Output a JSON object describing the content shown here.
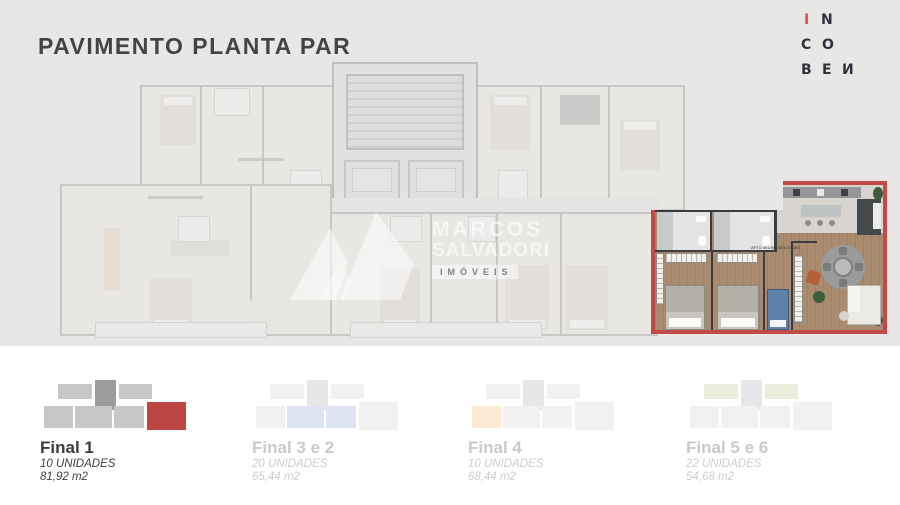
{
  "header": {
    "title": "PAVIMENTO PLANTA PAR"
  },
  "brand": {
    "letters": {
      "l1": "I",
      "l2": "N",
      "l3": "C",
      "l4": "O",
      "l5": "B",
      "l6": "E",
      "l7": "И"
    },
    "accent_color": "#de5147"
  },
  "watermark": {
    "line1": "MARCOS",
    "line2": "SALVADORI",
    "line3": "IMÓVEIS"
  },
  "floorplan": {
    "highlight_border_color": "#c04b48",
    "unit_label": "APTO 401/501/601/701/801"
  },
  "unit_options": [
    {
      "name": "Final 1",
      "units": "10 UNIDADES",
      "area": "81,92 m2",
      "active": true,
      "highlight_color": "#bb4543"
    },
    {
      "name": "Final 3 e 2",
      "units": "20 UNIDADES",
      "area": "65,44 m2",
      "active": false,
      "highlight_color": "#dfe4f4"
    },
    {
      "name": "Final 4",
      "units": "10 UNIDADES",
      "area": "68,44 m2",
      "active": false,
      "highlight_color": "#fbe9d3"
    },
    {
      "name": "Final 5 e 6",
      "units": "22 UNIDADES",
      "area": "54,68 m2",
      "active": false,
      "highlight_color": "#eceedb"
    }
  ]
}
